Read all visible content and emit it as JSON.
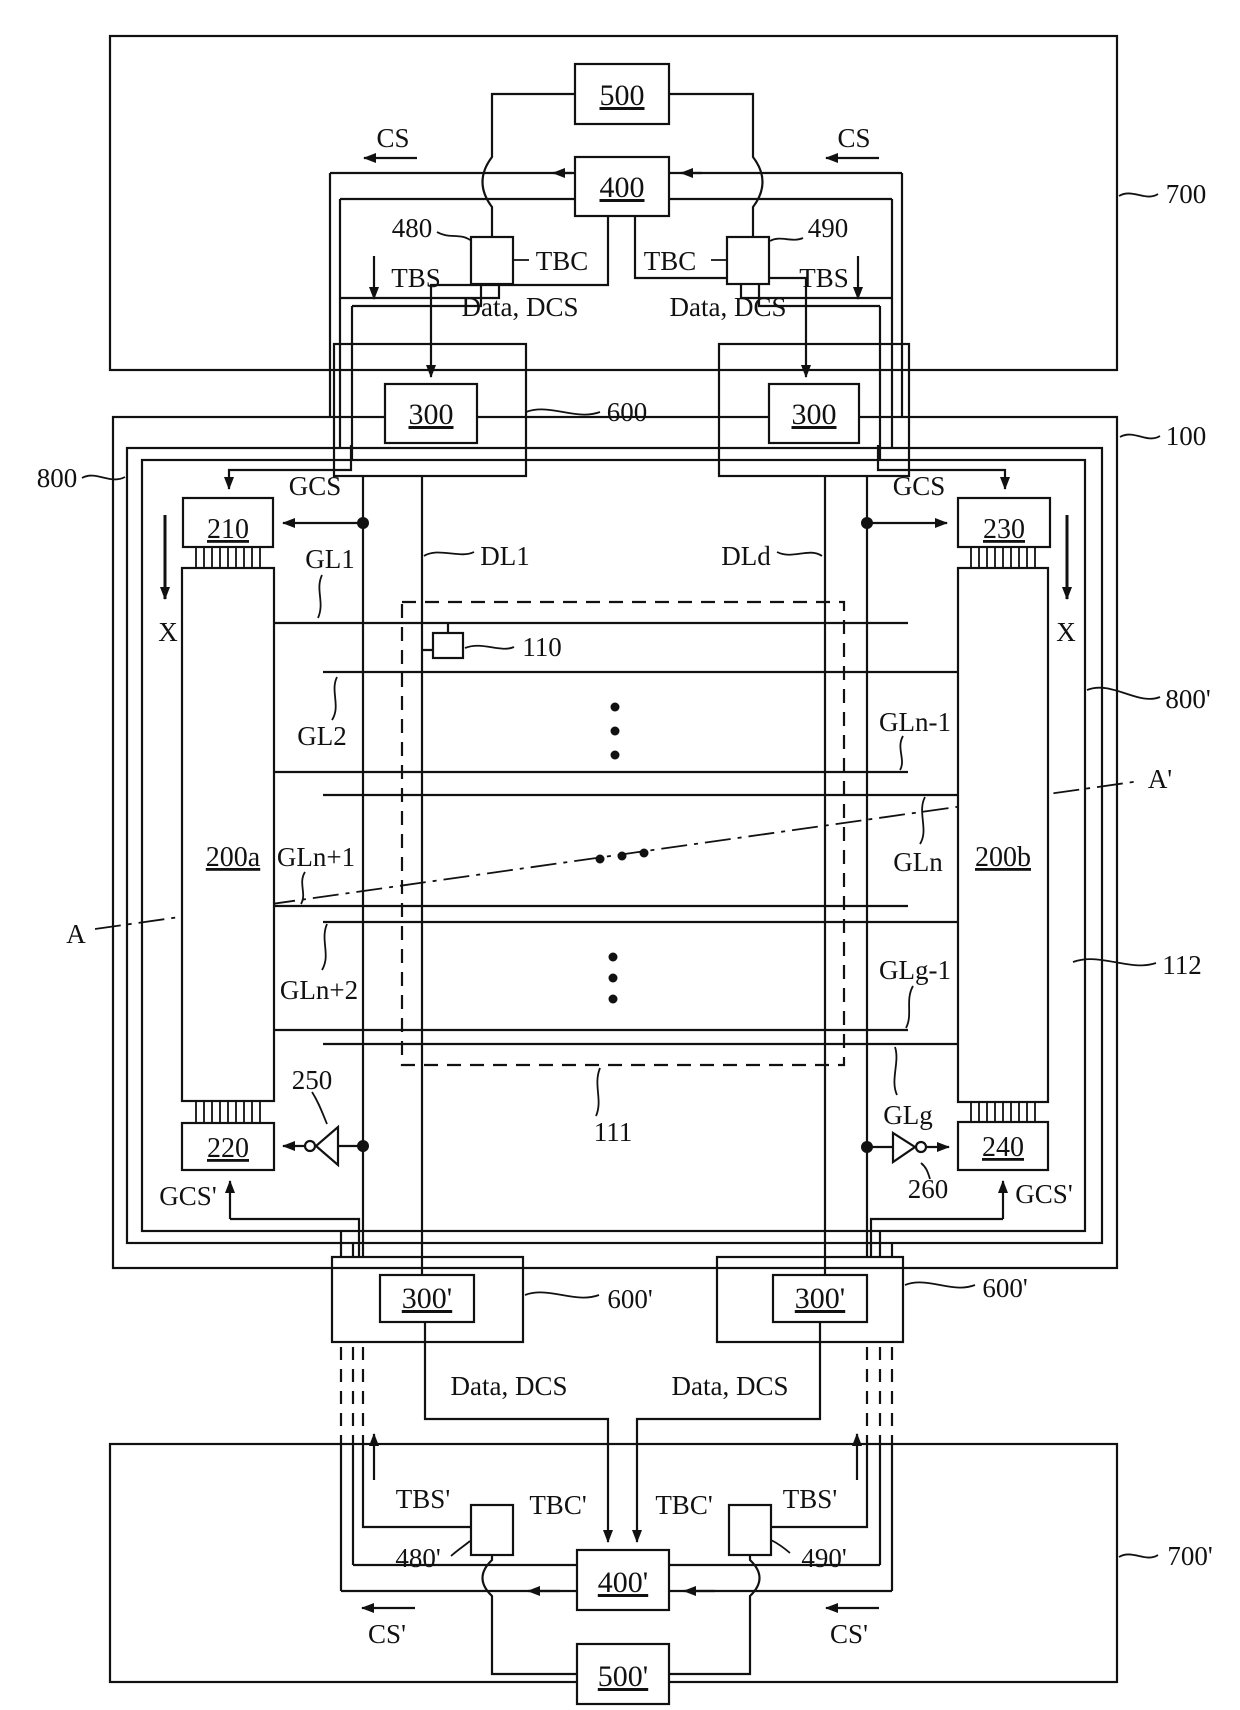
{
  "title": "display panel circuit patent figure",
  "labels": {
    "b500": "500",
    "b400": "400",
    "b300": "300",
    "b300p": "300'",
    "b400p": "400'",
    "b500p": "500'",
    "b210": "210",
    "b230": "230",
    "b220": "220",
    "b240": "240",
    "b200a": "200a",
    "b200b": "200b",
    "r700": "700",
    "r700p": "700'",
    "r100": "100",
    "r800": "800",
    "r800p": "800'",
    "r112": "112",
    "r111": "111",
    "r110": "110",
    "r480": "480",
    "r490": "490",
    "r480p": "480'",
    "r490p": "490'",
    "r250": "250",
    "r260": "260",
    "r600": "600",
    "r600p": "600'",
    "cs": "CS",
    "csp": "CS'",
    "tbs": "TBS",
    "tbsp": "TBS'",
    "tbc": "TBC",
    "tbcp": "TBC'",
    "gcs": "GCS",
    "gcsp": "GCS'",
    "data_dcs": "Data, DCS",
    "gl1": "GL1",
    "gl2": "GL2",
    "gln_m1": "GLn-1",
    "gln": "GLn",
    "gln_p1": "GLn+1",
    "gln_p2": "GLn+2",
    "glg_m1": "GLg-1",
    "glg": "GLg",
    "dl1": "DL1",
    "dld": "DLd",
    "a": "A",
    "a_prime": "A'",
    "x": "X"
  },
  "line_color": "#111111",
  "background": "#ffffff"
}
